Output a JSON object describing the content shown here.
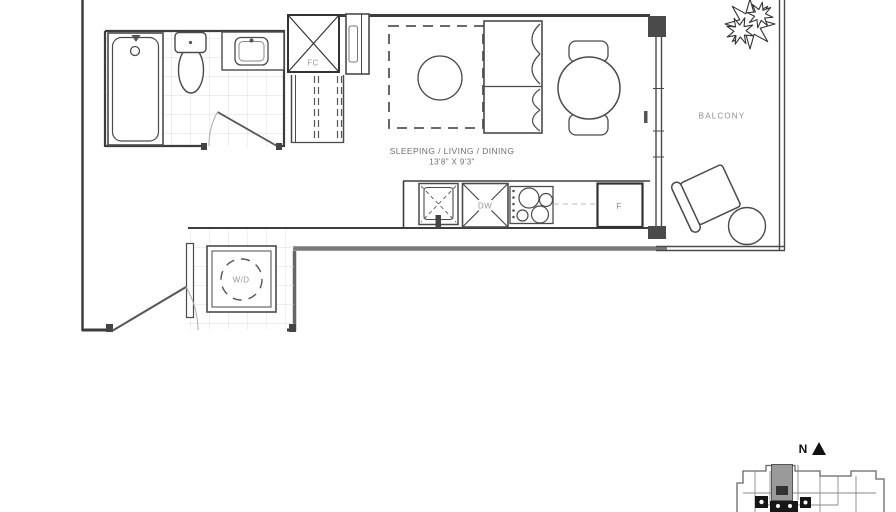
{
  "floorplan": {
    "main_room": {
      "label": "SLEEPING / LIVING / DINING",
      "dimensions": "13'8\" X 9'3\""
    },
    "balcony": {
      "label": "BALCONY"
    },
    "fixture_labels": {
      "fan_coil": "FC",
      "dishwasher": "DW",
      "fridge": "F",
      "washer_dryer": "W/D"
    },
    "compass": {
      "north": "N"
    }
  },
  "colors": {
    "wall_line": "#3d3d3d",
    "fixture_line": "#555555",
    "tile_line": "#dcdcdc",
    "label_gray": "#8a8a8a",
    "keyplan_highlight": "#9a9a9a"
  }
}
